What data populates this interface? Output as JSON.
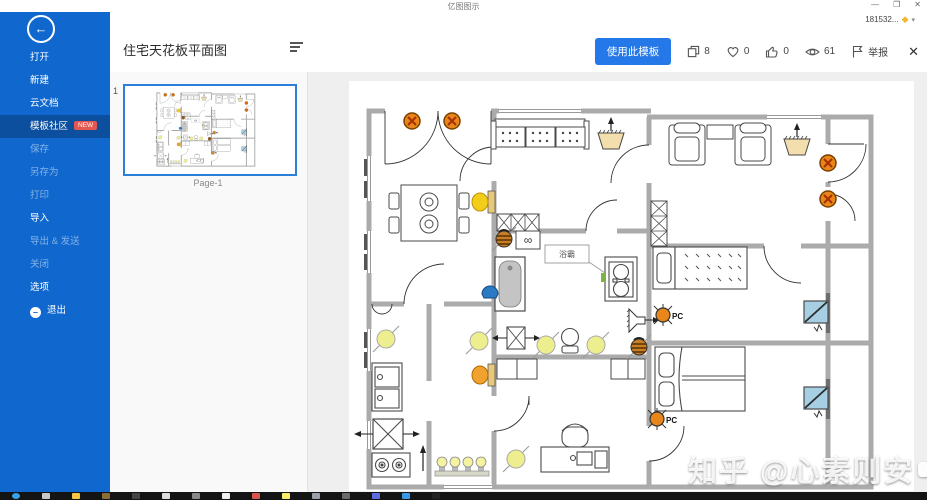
{
  "titlebar": {
    "app_title": "亿图图示",
    "minimize": "—",
    "restore": "❐",
    "close": "✕",
    "account": "181532...",
    "account_caret": "▾",
    "gem": "◆"
  },
  "sidebar": {
    "back_arrow": "←",
    "new_badge": "NEW",
    "exit_minus": "–",
    "items": [
      {
        "label": "打开"
      },
      {
        "label": "新建"
      },
      {
        "label": "云文档"
      },
      {
        "label": "模板社区"
      },
      {
        "label": "保存"
      },
      {
        "label": "另存为"
      },
      {
        "label": "打印"
      },
      {
        "label": "导入"
      },
      {
        "label": "导出 & 发送"
      },
      {
        "label": "关闭"
      },
      {
        "label": "选项"
      },
      {
        "label": "退出"
      }
    ]
  },
  "header": {
    "doc_title": "住宅天花板平面图",
    "use_template": "使用此模板",
    "copies": "8",
    "favorites": "0",
    "likes": "0",
    "views": "61",
    "report": "举报",
    "close": "✕"
  },
  "pages_panel": {
    "index": "1",
    "page_label": "Page-1"
  },
  "plan": {
    "bath_heater": "浴霸",
    "pc1": "PC",
    "pc2": "PC",
    "infinity": "∞"
  },
  "watermark": {
    "text": "知乎 @心素则安"
  }
}
